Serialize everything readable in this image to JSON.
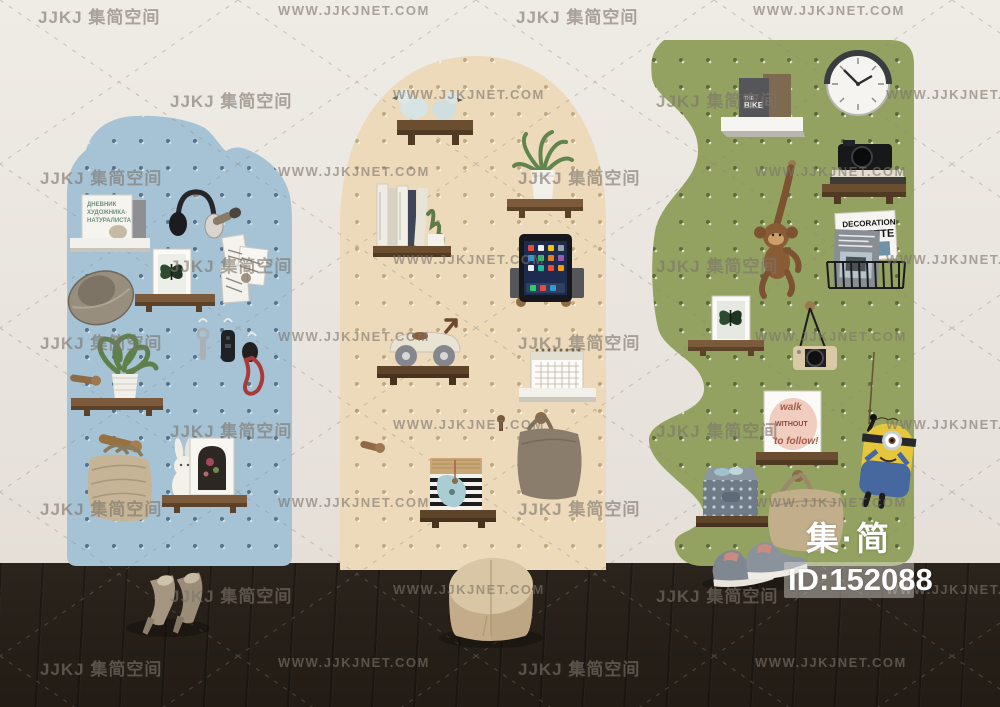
{
  "image_type": "3d-render-stock-photo",
  "brand": {
    "logo": "集·简",
    "id_label": "ID:152088"
  },
  "watermark": {
    "logo_text": "JJKJ 集简空间",
    "url_text": "WWW.JJKJNET.COM",
    "rows": [
      {
        "y": 3,
        "xs": [
          {
            "x": 38,
            "t": "logo"
          },
          {
            "x": 278,
            "t": "url"
          },
          {
            "x": 516,
            "t": "logo"
          },
          {
            "x": 753,
            "t": "url"
          }
        ]
      },
      {
        "y": 87,
        "xs": [
          {
            "x": 170,
            "t": "logo"
          },
          {
            "x": 393,
            "t": "url"
          },
          {
            "x": 656,
            "t": "logo"
          },
          {
            "x": 886,
            "t": "url"
          }
        ]
      },
      {
        "y": 164,
        "xs": [
          {
            "x": 40,
            "t": "logo"
          },
          {
            "x": 278,
            "t": "url"
          },
          {
            "x": 518,
            "t": "logo"
          },
          {
            "x": 755,
            "t": "url"
          }
        ]
      },
      {
        "y": 252,
        "xs": [
          {
            "x": 170,
            "t": "logo"
          },
          {
            "x": 393,
            "t": "url"
          },
          {
            "x": 656,
            "t": "logo"
          },
          {
            "x": 886,
            "t": "url"
          }
        ]
      },
      {
        "y": 329,
        "xs": [
          {
            "x": 40,
            "t": "logo"
          },
          {
            "x": 278,
            "t": "url"
          },
          {
            "x": 518,
            "t": "logo"
          },
          {
            "x": 755,
            "t": "url"
          }
        ]
      },
      {
        "y": 417,
        "xs": [
          {
            "x": 170,
            "t": "logo"
          },
          {
            "x": 393,
            "t": "url"
          },
          {
            "x": 656,
            "t": "logo"
          },
          {
            "x": 886,
            "t": "url"
          }
        ]
      },
      {
        "y": 495,
        "xs": [
          {
            "x": 40,
            "t": "logo"
          },
          {
            "x": 278,
            "t": "url"
          },
          {
            "x": 518,
            "t": "logo"
          },
          {
            "x": 755,
            "t": "url"
          }
        ]
      },
      {
        "y": 582,
        "xs": [
          {
            "x": 170,
            "t": "logo"
          },
          {
            "x": 393,
            "t": "url"
          },
          {
            "x": 656,
            "t": "logo"
          },
          {
            "x": 886,
            "t": "url"
          }
        ]
      },
      {
        "y": 655,
        "xs": [
          {
            "x": 40,
            "t": "logo"
          },
          {
            "x": 278,
            "t": "url"
          },
          {
            "x": 518,
            "t": "logo"
          },
          {
            "x": 755,
            "t": "url"
          }
        ]
      }
    ]
  },
  "texts": {
    "russian_book_l1": "ДНЕВНИК",
    "russian_book_l2": "ХУДОЖНИКА·",
    "russian_book_l3": "НАТУРАЛИСТА",
    "bike_the": "THE",
    "bike_title": "BIKE",
    "mag_l1": "DECORATION",
    "mag_l2": "GAZETTE",
    "quote_l1": "walk",
    "quote_l2": "WITHOUT",
    "quote_l3": "to follow!"
  },
  "colors": {
    "wall": "#e9e4de",
    "floor": "#262019",
    "board_blue": "#a6c3d5",
    "board_cream": "#ecdabb",
    "board_green": "#93a261",
    "shelf_wood": "#7b5b3b",
    "shelf_white": "#f4f2ee"
  },
  "boards": {
    "blue": {
      "shape": "scalloped-cloud-top",
      "color": "#a6c3d5",
      "items": [
        "magazine-display-shelf",
        "headphones",
        "microphone",
        "pinned-postcards",
        "butterfly-frame",
        "straw-hat",
        "key-hooks",
        "car-key-fob",
        "red-lanyard-keys",
        "potted-plant",
        "wooden-peg",
        "jute-tote-bag",
        "rabbit-figurine",
        "arch-photo-frame"
      ]
    },
    "cream": {
      "shape": "arched-top",
      "color": "#ecdabb",
      "items": [
        "bird-figurines",
        "book-row",
        "cactus-pot",
        "spider-plant",
        "tablet-on-stand",
        "toy-race-car",
        "desk-calendar",
        "wooden-peg",
        "canvas-tote-bag",
        "striped-birdhouse-box"
      ]
    },
    "green": {
      "shape": "wavy-left-edge",
      "color": "#93a261",
      "items": [
        "wall-clock",
        "bike-book",
        "white-box-shelf",
        "camera-on-books",
        "wooden-monkey-toy",
        "magazine-rack",
        "butterfly-frame",
        "hanging-camera",
        "quote-canvas",
        "polka-dot-storage-box",
        "canvas-tote-bag",
        "minion-toy-on-rope",
        "sneakers"
      ]
    }
  },
  "floor_items": [
    "high-heel-shoes",
    "round-pouf"
  ]
}
